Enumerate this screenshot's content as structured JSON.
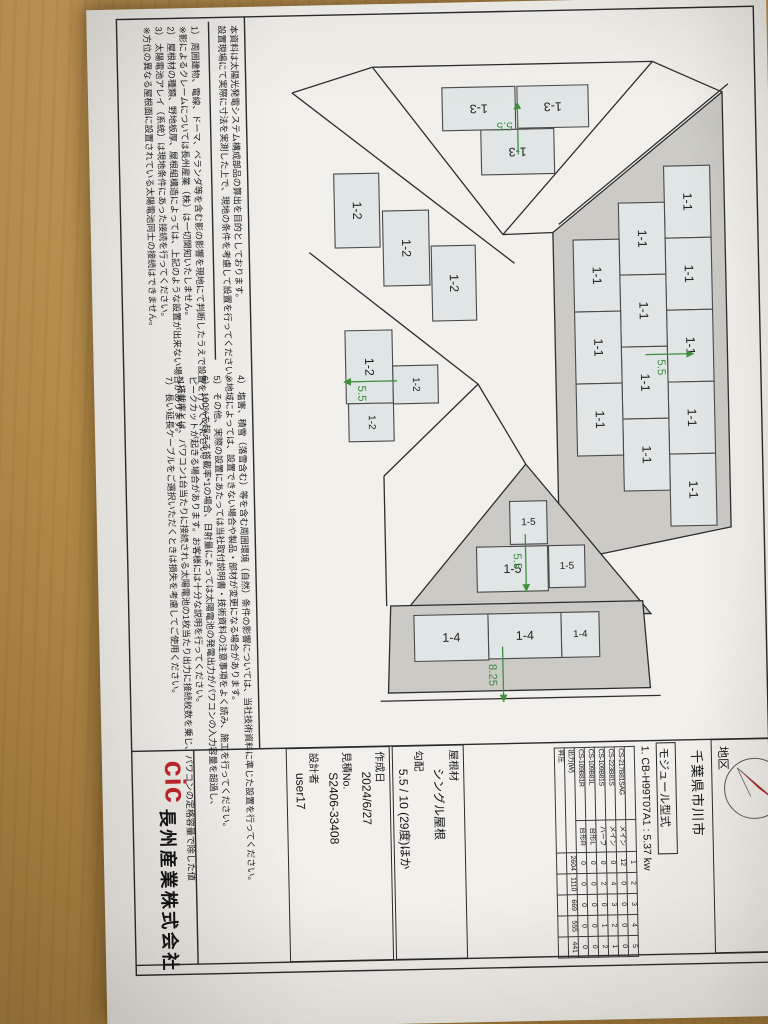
{
  "district": {
    "label": "地区",
    "value": "千葉県市川市"
  },
  "module": {
    "title": "モジュール型式",
    "system": "1. CB-H99T07A1 : 5.37 kw",
    "col_headers": [
      "1",
      "2",
      "3",
      "4",
      "5"
    ],
    "rows": [
      [
        "CS-217B81SAG",
        "メイン",
        "12",
        "0",
        "0",
        "0",
        "0"
      ],
      [
        "CS-223B81S",
        "メイン",
        "0",
        "4",
        "3",
        "2",
        "1"
      ],
      [
        "CS-109B81S",
        "ハーフ",
        "0",
        "2",
        "0",
        "1",
        "2"
      ],
      [
        "CS-109B81L",
        "台形L",
        "0",
        "0",
        "0",
        "0",
        "0"
      ],
      [
        "CS-109B81R",
        "台形R",
        "0",
        "0",
        "0",
        "0",
        "0"
      ]
    ],
    "output_row": [
      "出力(W)",
      "2604",
      "1110",
      "669",
      "555",
      "441"
    ],
    "boost_row": [
      "昇圧",
      "",
      "",
      "",
      "",
      ""
    ]
  },
  "roof_info": {
    "material_label": "屋根材",
    "material": "シングル屋根",
    "pitch_label": "勾配",
    "pitch": "5.5 / 10 (29度)ほか"
  },
  "meta": {
    "created_label": "作成日",
    "created": "2024/6/27",
    "quote_label": "見積No.",
    "quote": "S2406-33408",
    "designer_label": "設計者",
    "designer": "user17"
  },
  "company": {
    "logo": "cic",
    "name": "長州産業株式会社"
  },
  "notes": {
    "intro": [
      "本資料は太陽光発電システム構成部品の算出を目的としております。",
      "設置現場にて実際に寸法を実測した上で、現地の条件を考慮して設置を行ってください。"
    ],
    "col1": [
      "1） 周囲建物、電線、ドーマ、ベランダ等を含む影の影響を現地にて判断したうえで設置を行ってください。",
      "※影によるクレームについては長州産業（株）は一切関知いたしません。",
      "2） 屋根材の種類、野地板厚、屋根組構造によっては、上記のような設置が出来ない場合があります。",
      "3） 太陽電池アレイ（系統）は現地条件にあった接続を行ってください。",
      "※方位の異なる屋根面に設置されている太陽電池同士の接続はできません。"
    ],
    "col2": [
      "4） 塩害、積雪（落雪含む）等を含む周囲環境（自然）条件の影響については、当社技術資料に準じた設置を行ってください。",
      "※地域によっては、設置できない場合や製品・部材が変更になる場合があります。",
      "5） その他、実際の設置にあたっては当社取付説明書・技術資料の注意事項をよく読み、施工を行ってください。",
      "6） 100%を超える搭載率*1の場合、日射量によっては太陽電池の発電出力がパワコンの入力容量を超過し、",
      "ピークカットが起きる場合があります。お客様には十分な説明を行ってください。",
      "*1搭載率とは、パワコン1台当たりに接続される太陽電池の1枚当たり出力に接続枚数を乗じ、パワコンの定格容量で除した値",
      "7） 長い延長ケーブルをご選択いただくときは損失を考慮してご使用ください。"
    ]
  },
  "roof": {
    "areas": [
      {
        "id": "1-1",
        "pitch": "5.5"
      },
      {
        "id": "1-2",
        "pitch": "5.5"
      },
      {
        "id": "1-3",
        "pitch": "5.5"
      },
      {
        "id": "1-4",
        "pitch": "8.25"
      },
      {
        "id": "1-5",
        "pitch": "5.5"
      }
    ]
  }
}
